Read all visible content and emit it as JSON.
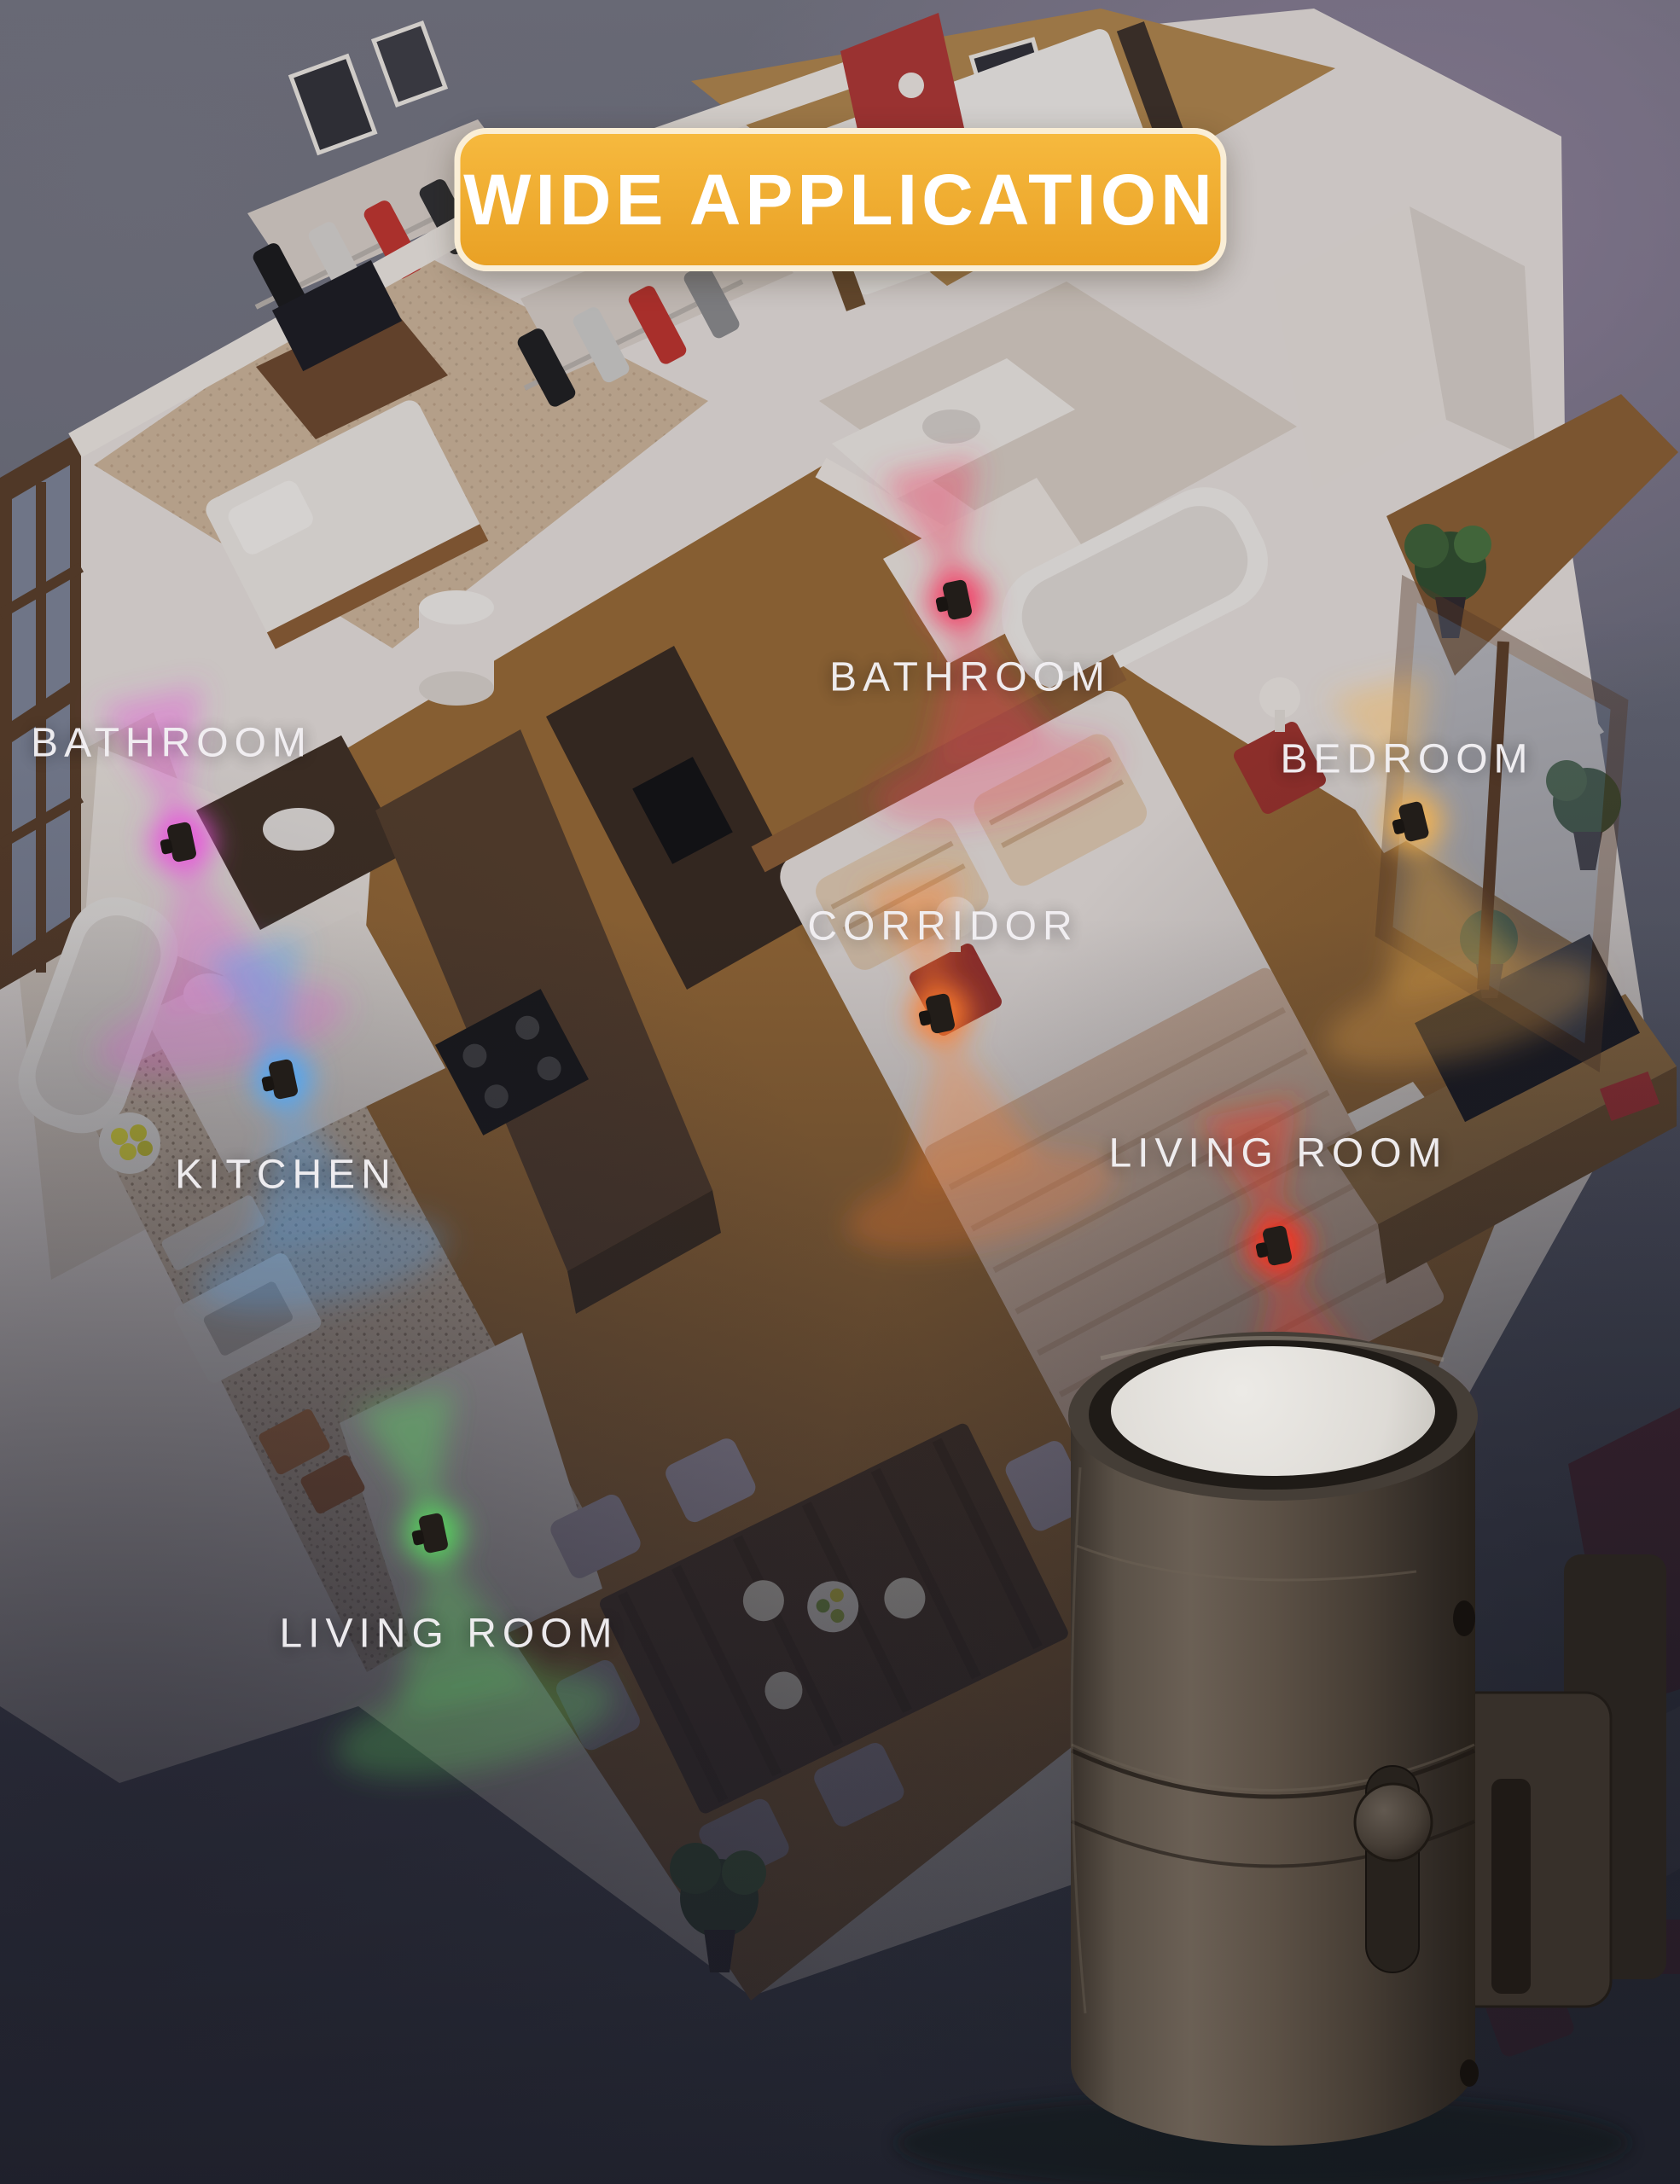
{
  "badge": {
    "label": "WIDE APPLICATION",
    "background_top": "#f6b93e",
    "background_bottom": "#e9a125",
    "border_color": "#faeed6",
    "text_color": "#ffffff"
  },
  "rooms": [
    {
      "id": "bathroom-left",
      "label": "BATHROOM",
      "light_color": "#e851db"
    },
    {
      "id": "bathroom-main",
      "label": "BATHROOM",
      "light_color": "#f43560"
    },
    {
      "id": "bedroom",
      "label": "BEDROOM",
      "light_color": "#f7b34d"
    },
    {
      "id": "corridor",
      "label": "CORRIDOR",
      "light_color": "#ff7c2b"
    },
    {
      "id": "kitchen",
      "label": "KITCHEN",
      "light_color": "#4da6f8"
    },
    {
      "id": "living-room-tv",
      "label": "LIVING ROOM",
      "light_color": "#ff2f1e"
    },
    {
      "id": "living-room-lounge",
      "label": "LIVING ROOM",
      "light_color": "#57d55e"
    }
  ],
  "label_text_color": "#f2f0f3",
  "background": {
    "top": "#73747f",
    "purple_tint": "#8f7f99",
    "slate": "#5a5d6c",
    "bottom": "#494d5b"
  },
  "product": {
    "body_color": "#6b6055",
    "lens_color": "#eceae6"
  }
}
